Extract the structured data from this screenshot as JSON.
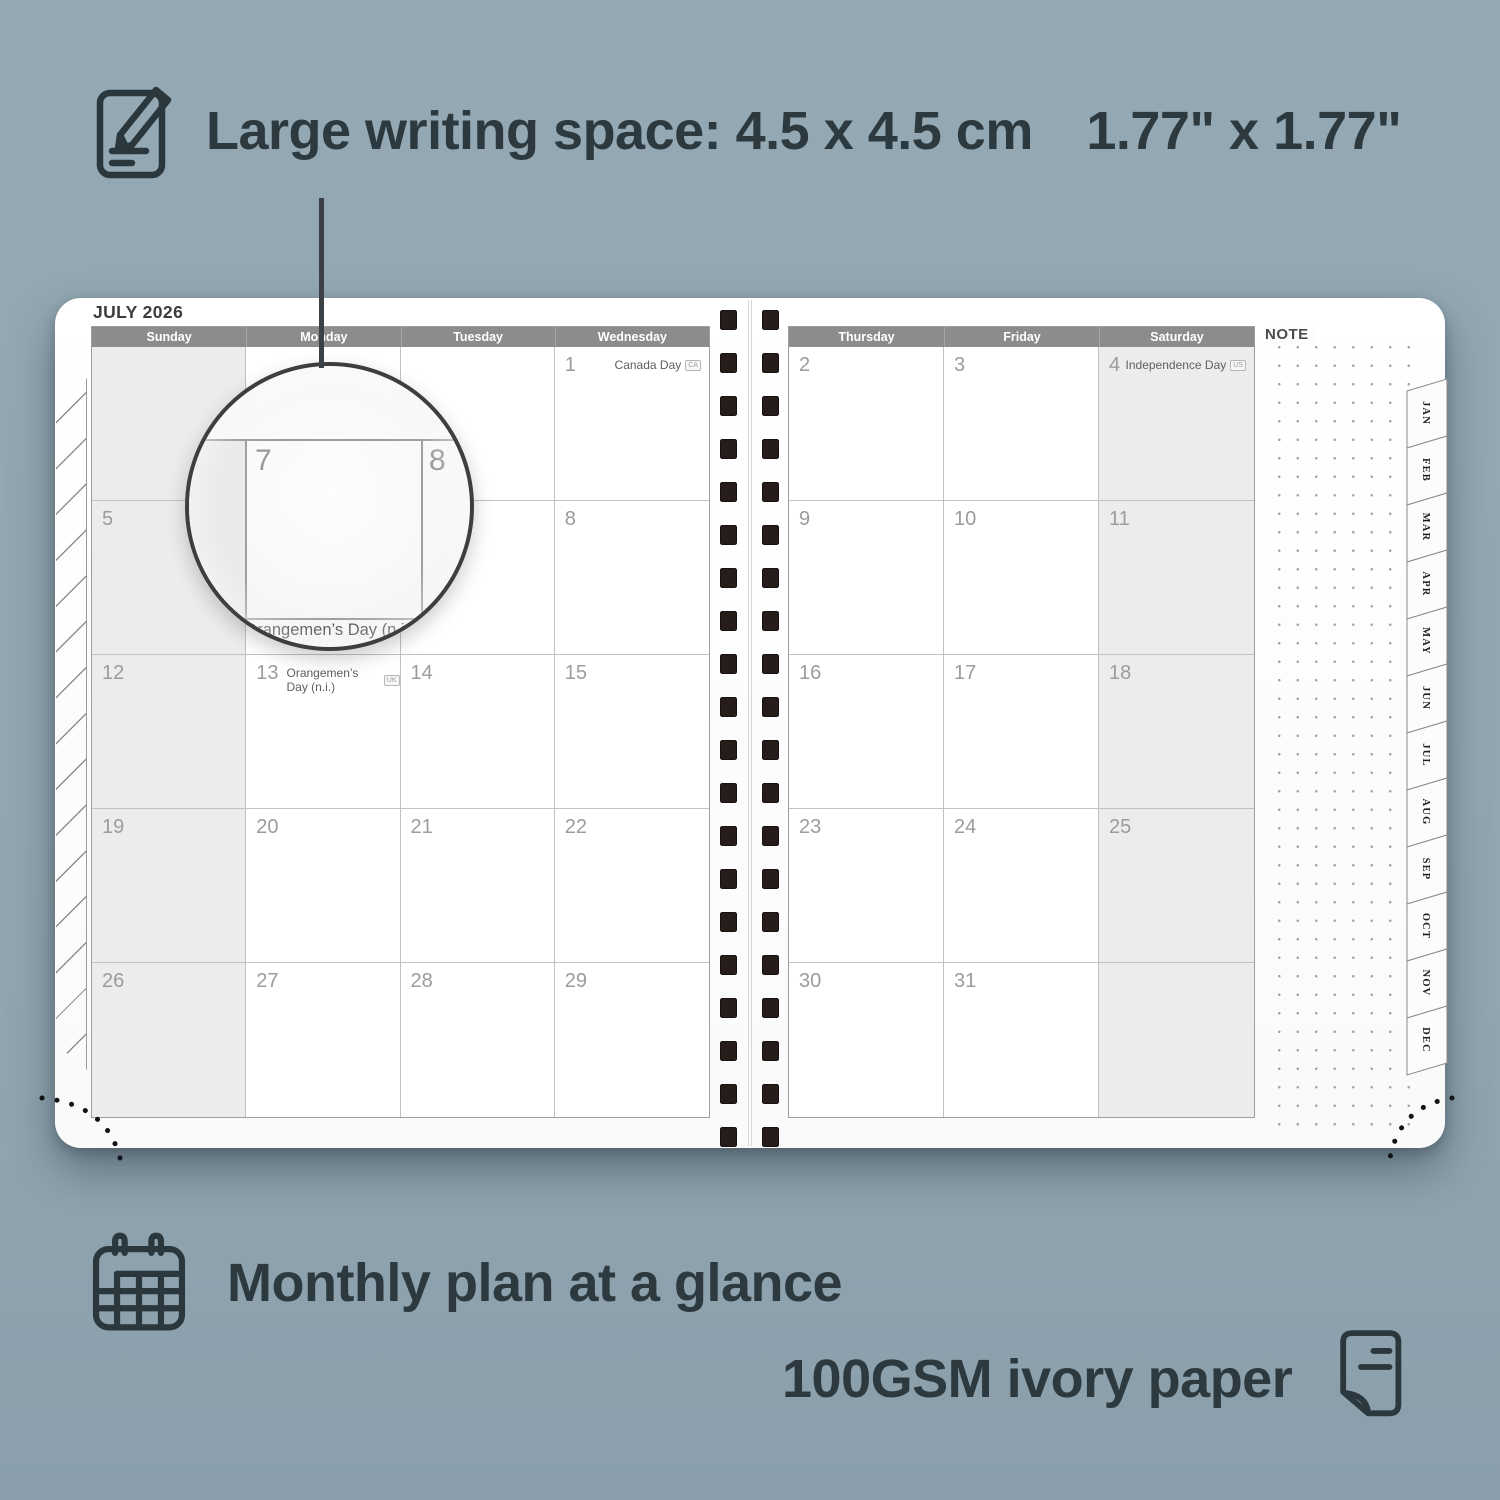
{
  "background_color": "#93a7b2",
  "annotations": {
    "text_color": "#2c393f",
    "top": {
      "icon": "note-pencil-icon",
      "text": "Large writing space: 4.5 x 4.5 cm 1.77\" x 1.77\""
    },
    "bottom_left": {
      "icon": "calendar-grid-icon",
      "text": "Monthly plan at a glance"
    },
    "bottom_right": {
      "icon": "paper-sheet-icon",
      "text": "100GSM ivory paper"
    }
  },
  "planner": {
    "month_title": "JULY 2026",
    "note_label": "NOTE",
    "header_bg": "#8c8c8c",
    "shaded_cell_bg": "#ececec",
    "left_page": {
      "day_headers": [
        "Sunday",
        "Monday",
        "Tuesday",
        "Wednesday"
      ],
      "cells": [
        {
          "day": "",
          "shaded": true
        },
        {
          "day": ""
        },
        {
          "day": ""
        },
        {
          "day": "1",
          "holiday": "Canada Day",
          "badge": "CA",
          "holiday_right": true
        },
        {
          "day": "5",
          "shaded": true
        },
        {
          "day": "6"
        },
        {
          "day": "7"
        },
        {
          "day": "8"
        },
        {
          "day": "12",
          "shaded": true
        },
        {
          "day": "13",
          "holiday": "Orangemen’s Day (n.i.)",
          "badge": "UK",
          "holiday_right": false
        },
        {
          "day": "14"
        },
        {
          "day": "15"
        },
        {
          "day": "19",
          "shaded": true
        },
        {
          "day": "20"
        },
        {
          "day": "21"
        },
        {
          "day": "22"
        },
        {
          "day": "26",
          "shaded": true
        },
        {
          "day": "27"
        },
        {
          "day": "28"
        },
        {
          "day": "29"
        }
      ]
    },
    "right_page": {
      "day_headers": [
        "Thursday",
        "Friday",
        "Saturday"
      ],
      "cells": [
        {
          "day": "2"
        },
        {
          "day": "3"
        },
        {
          "day": "4",
          "shaded": true,
          "holiday": "Independence Day",
          "badge": "US",
          "holiday_right": true
        },
        {
          "day": "9"
        },
        {
          "day": "10"
        },
        {
          "day": "11",
          "shaded": true
        },
        {
          "day": "16"
        },
        {
          "day": "17"
        },
        {
          "day": "18",
          "shaded": true
        },
        {
          "day": "23"
        },
        {
          "day": "24"
        },
        {
          "day": "25",
          "shaded": true
        },
        {
          "day": "30"
        },
        {
          "day": "31"
        },
        {
          "day": "",
          "shaded": true
        }
      ]
    },
    "month_tabs": [
      "JAN",
      "FEB",
      "MAR",
      "APR",
      "MAY",
      "JUN",
      "JUL",
      "AUG",
      "SEP",
      "OCT",
      "NOV",
      "DEC"
    ],
    "magnifier": {
      "left_day": "7",
      "right_day": "8",
      "caption": "Orangemen’s Day (n.i.)"
    }
  }
}
